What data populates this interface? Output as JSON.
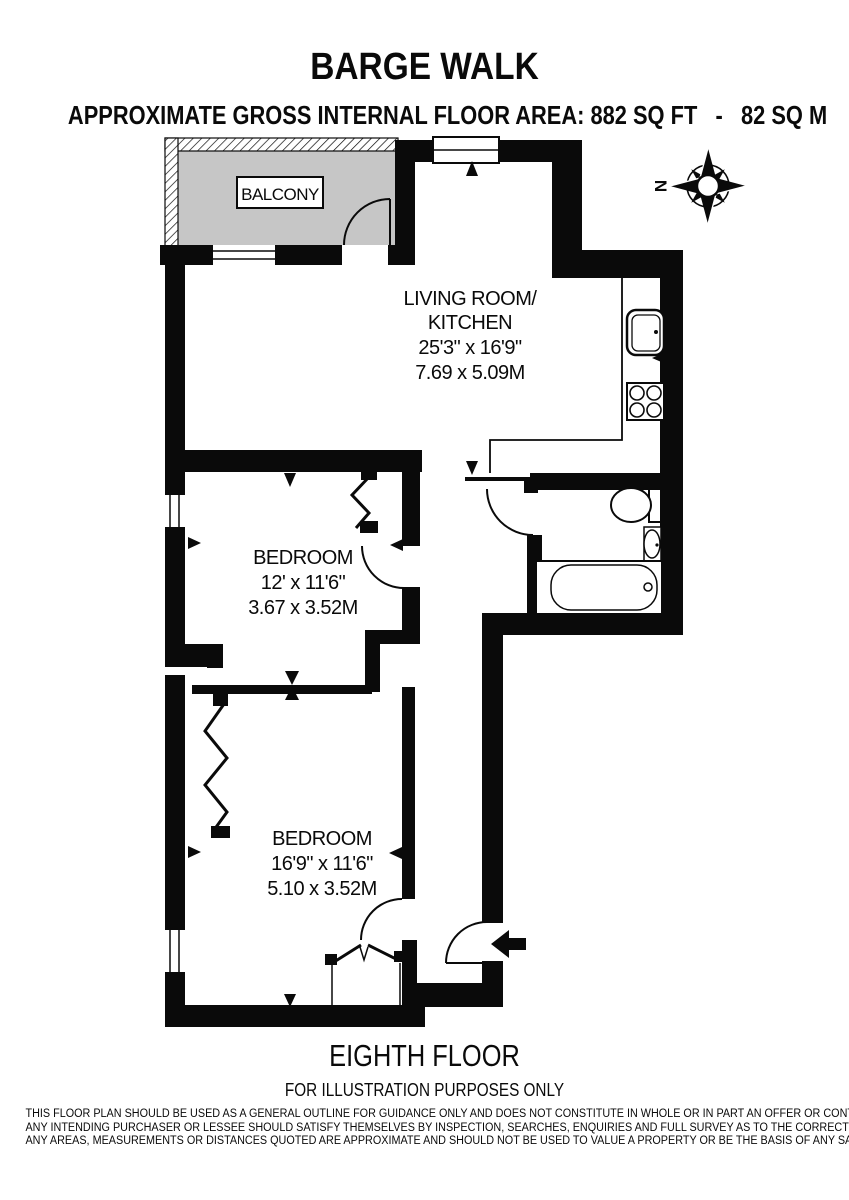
{
  "header": {
    "title": "BARGE WALK",
    "subtitle": "APPROXIMATE GROSS INTERNAL FLOOR AREA: 882 SQ FT   -   82 SQ M"
  },
  "plan": {
    "balcony": {
      "label": "BALCONY"
    },
    "compass": {
      "north": "N"
    },
    "living_kitchen": {
      "lines": [
        "LIVING ROOM/",
        "KITCHEN",
        "25'3\" x 16'9\"",
        "7.69 x 5.09M"
      ]
    },
    "bedroom1": {
      "lines": [
        "BEDROOM",
        "12' x 11'6\"",
        "3.67 x 3.52M"
      ]
    },
    "bedroom2": {
      "lines": [
        "BEDROOM",
        "16'9\" x 11'6\"",
        "5.10 x 3.52M"
      ]
    }
  },
  "footer": {
    "floor": "EIGHTH FLOOR",
    "note": "FOR ILLUSTRATION PURPOSES ONLY",
    "disclaimer": [
      "THIS FLOOR PLAN SHOULD BE USED AS A GENERAL OUTLINE FOR GUIDANCE ONLY AND DOES NOT CONSTITUTE IN WHOLE OR IN PART AN OFFER OR CONTRACT.",
      "ANY INTENDING PURCHASER OR LESSEE SHOULD SATISFY THEMSELVES BY INSPECTION, SEARCHES, ENQUIRIES AND FULL SURVEY AS TO THE CORRECTNESS OF EACH STATEMENT.",
      "ANY AREAS, MEASUREMENTS OR DISTANCES QUOTED ARE APPROXIMATE AND SHOULD NOT BE USED TO VALUE A PROPERTY OR BE THE BASIS OF ANY SALE OR LET."
    ]
  }
}
